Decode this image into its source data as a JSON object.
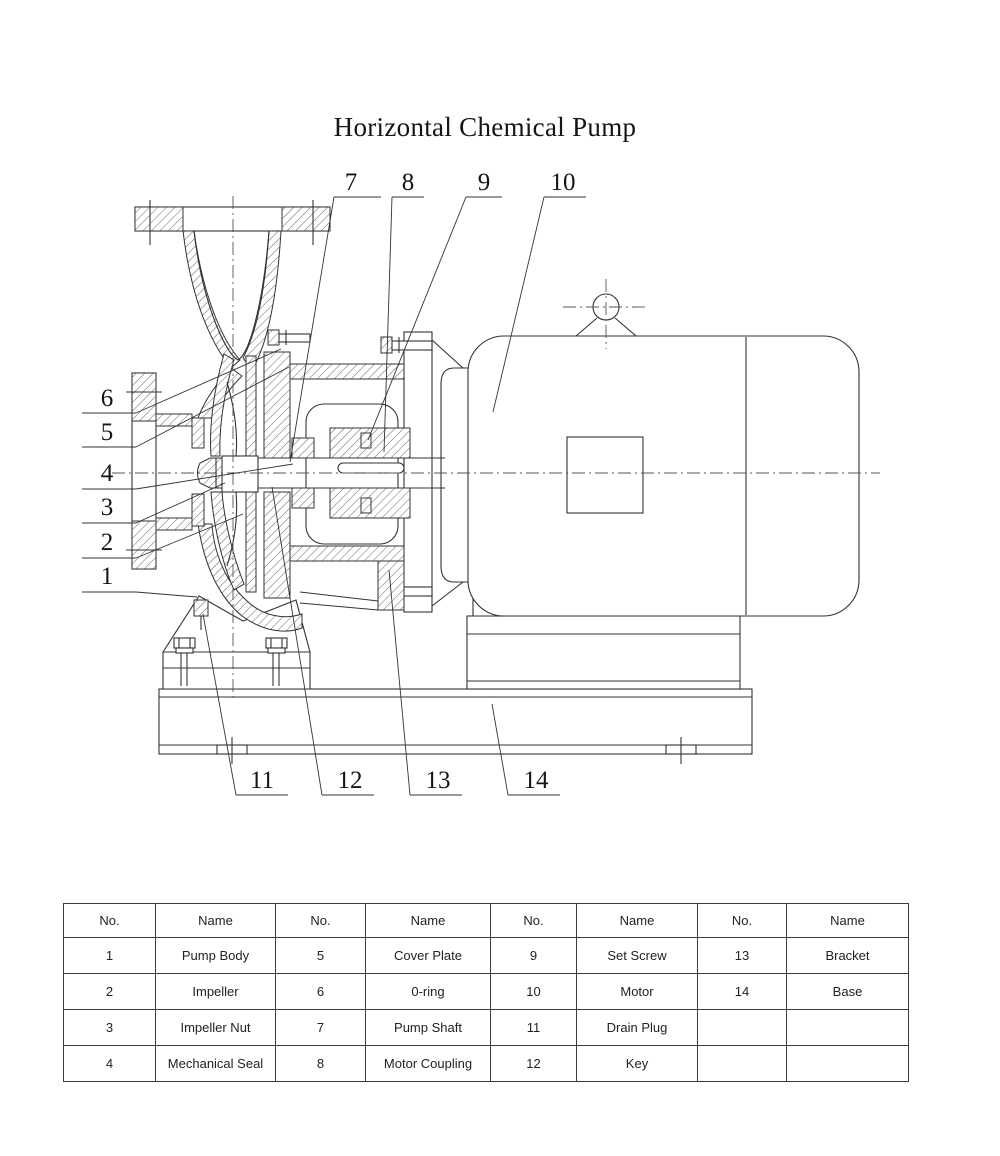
{
  "title": "Horizontal Chemical Pump",
  "colors": {
    "background": "#ffffff",
    "line": "#333333",
    "table_border": "#3b3b3b",
    "text": "#151515"
  },
  "callouts": [
    "1",
    "2",
    "3",
    "4",
    "5",
    "6",
    "7",
    "8",
    "9",
    "10",
    "11",
    "12",
    "13",
    "14"
  ],
  "diagram_parts": [
    {
      "no": "1",
      "name": "Pump Body"
    },
    {
      "no": "2",
      "name": "Impeller"
    },
    {
      "no": "3",
      "name": "Impeller Nut"
    },
    {
      "no": "4",
      "name": "Mechanical Seal"
    },
    {
      "no": "5",
      "name": "Cover Plate"
    },
    {
      "no": "6",
      "name": "0-ring"
    },
    {
      "no": "7",
      "name": "Pump Shaft"
    },
    {
      "no": "8",
      "name": "Motor Coupling"
    },
    {
      "no": "9",
      "name": "Set Screw"
    },
    {
      "no": "10",
      "name": "Motor"
    },
    {
      "no": "11",
      "name": "Drain Plug"
    },
    {
      "no": "12",
      "name": "Key"
    },
    {
      "no": "13",
      "name": "Bracket"
    },
    {
      "no": "14",
      "name": "Base"
    }
  ],
  "table": {
    "headers": [
      "No.",
      "Name",
      "No.",
      "Name",
      "No.",
      "Name",
      "No.",
      "Name"
    ],
    "col_widths": [
      92,
      120,
      90,
      125,
      86,
      121,
      89,
      122
    ],
    "rows": [
      [
        "1",
        "Pump Body",
        "5",
        "Cover Plate",
        "9",
        "Set Screw",
        "13",
        "Bracket"
      ],
      [
        "2",
        "Impeller",
        "6",
        "0-ring",
        "10",
        "Motor",
        "14",
        "Base"
      ],
      [
        "3",
        "Impeller Nut",
        "7",
        "Pump Shaft",
        "11",
        "Drain Plug",
        "",
        ""
      ],
      [
        "4",
        "Mechanical Seal",
        "8",
        "Motor Coupling",
        "12",
        "Key",
        "",
        ""
      ]
    ]
  }
}
